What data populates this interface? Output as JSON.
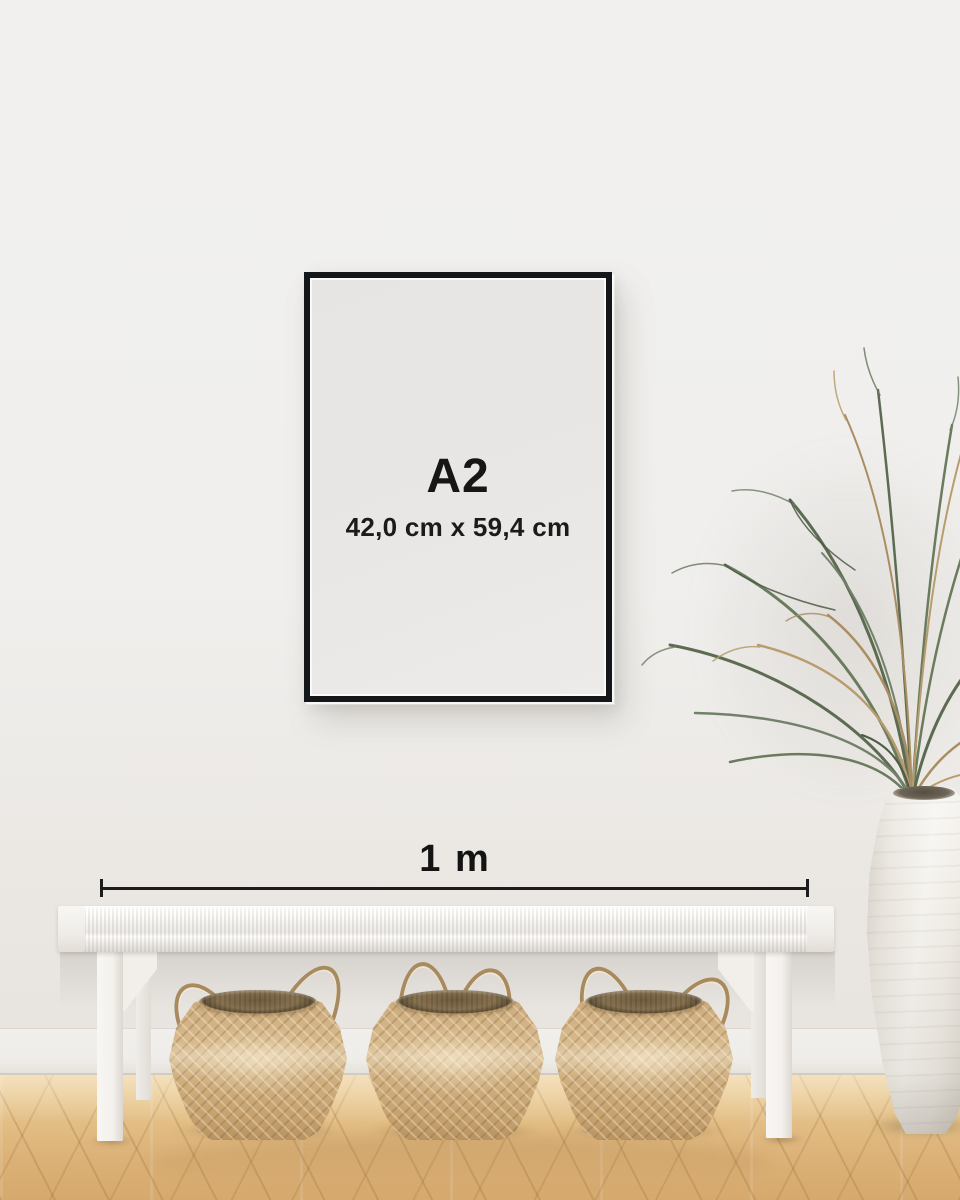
{
  "poster_frame": {
    "format": "A2",
    "dimensions": "42,0 cm x 59,4 cm"
  },
  "ruler": {
    "label": "1 m"
  },
  "palette": {
    "wall": "#f1f0ee",
    "frame": "#14171a",
    "poster": "#e9e7e5",
    "ink": "#161616",
    "floor_wood": "#ddb27a",
    "bench_white": "#f5f3f0",
    "basket_seagrass": "#cdab7d",
    "vase_white": "#f0ede7",
    "plant_olive": "#5d6b52",
    "plant_dried": "#a98e62"
  }
}
